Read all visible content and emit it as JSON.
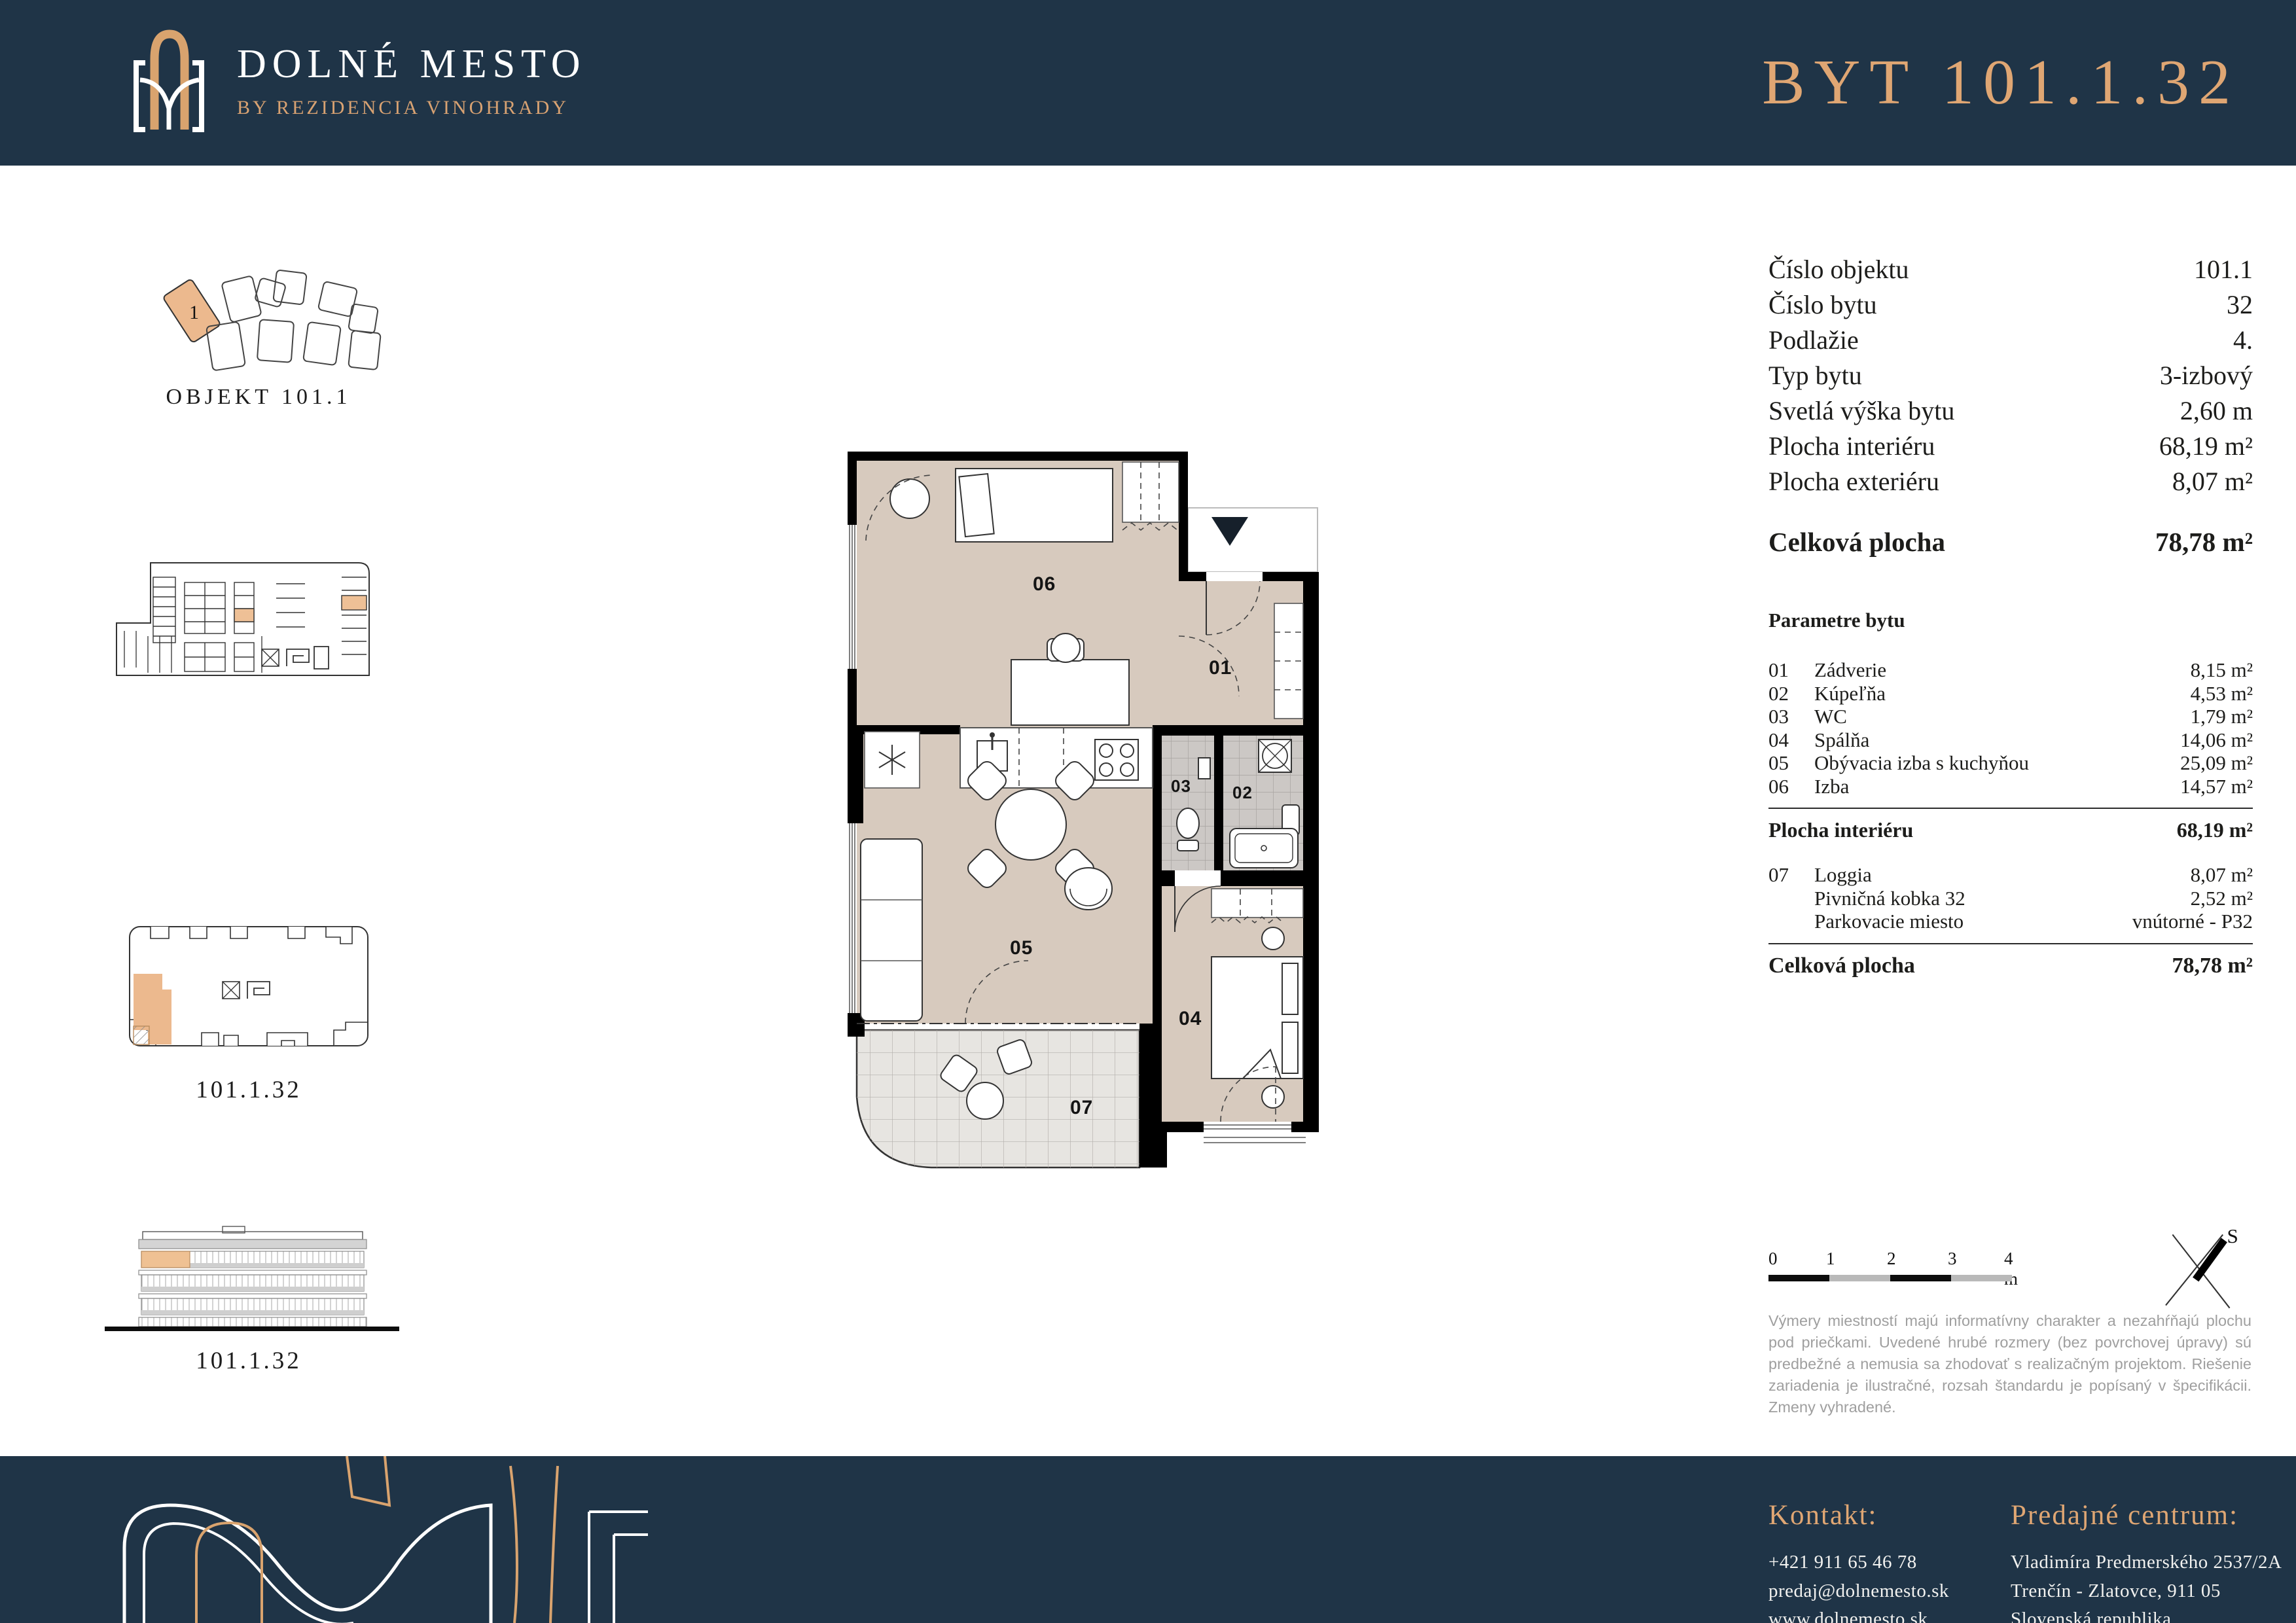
{
  "colors": {
    "navy": "#1f3447",
    "gold": "#dfa673",
    "beige": "#d7cabe",
    "tile": "#ccc8c5",
    "loggia": "#e7e5e1",
    "highlight": "#edbd92",
    "disclaimer_gray": "#9f9f9f"
  },
  "header": {
    "logo_title": "DOLNÉ MESTO",
    "logo_subtitle": "BY REZIDENCIA VINOHRADY",
    "apartment_title": "BYT 101.1.32"
  },
  "sidebar": {
    "site_plan": {
      "caption": "OBJEKT 101.1",
      "highlight_label": "1"
    },
    "floor_key": {
      "caption": "101.1.32"
    },
    "elevation": {
      "caption": "101.1.32"
    }
  },
  "plan": {
    "labels": {
      "r01": "01",
      "r02": "02",
      "r03": "03",
      "r04": "04",
      "r05": "05",
      "r06": "06",
      "r07": "07"
    }
  },
  "details": {
    "rows": [
      {
        "label": "Číslo objektu",
        "value": "101.1"
      },
      {
        "label": "Číslo bytu",
        "value": "32"
      },
      {
        "label": "Podlažie",
        "value": "4."
      },
      {
        "label": "Typ bytu",
        "value": "3-izbový"
      },
      {
        "label": "Svetlá výška bytu",
        "value": "2,60 m"
      },
      {
        "label": "Plocha interiéru",
        "value": "68,19 m²"
      },
      {
        "label": "Plocha exteriéru",
        "value": "8,07 m²"
      }
    ],
    "total": {
      "label": "Celková plocha",
      "value": "78,78 m²"
    }
  },
  "parameters": {
    "title": "Parametre bytu",
    "rows": [
      {
        "num": "01",
        "label": "Zádverie",
        "value": "8,15 m²"
      },
      {
        "num": "02",
        "label": "Kúpeľňa",
        "value": "4,53 m²"
      },
      {
        "num": "03",
        "label": "WC",
        "value": "1,79 m²"
      },
      {
        "num": "04",
        "label": "Spálňa",
        "value": "14,06 m²"
      },
      {
        "num": "05",
        "label": "Obývacia izba s kuchyňou",
        "value": "25,09 m²"
      },
      {
        "num": "06",
        "label": "Izba",
        "value": "14,57 m²"
      }
    ],
    "interior": {
      "label": "Plocha interiéru",
      "value": "68,19 m²"
    },
    "extras": [
      {
        "num": "07",
        "label": "Loggia",
        "value": "8,07 m²"
      },
      {
        "num": "",
        "label": "Pivničná kobka 32",
        "value": "2,52 m²"
      },
      {
        "num": "",
        "label": "Parkovacie miesto",
        "value": "vnútorné - P32"
      }
    ],
    "total": {
      "label": "Celková plocha",
      "value": "78,78 m²"
    }
  },
  "scale_bar": {
    "labels": [
      "0",
      "1",
      "2",
      "3",
      "4 m"
    ]
  },
  "compass": {
    "label": "S"
  },
  "disclaimer": "Výmery miestností majú informatívny charakter a nezahŕňajú plochu pod priečkami. Uvedené hrubé rozmery (bez povrchovej úpravy) sú predbežné a nemusia sa zhodovať s realizačným projektom. Riešenie zariadenia je ilustračné, rozsah štandardu je popísaný v špecifikácii. Zmeny vyhradené.",
  "footer": {
    "contact": {
      "title": "Kontakt:",
      "lines": [
        "+421 911 65 46 78",
        "predaj@dolnemesto.sk",
        "www.dolnemesto.sk"
      ]
    },
    "sales": {
      "title": "Predajné centrum:",
      "lines": [
        "Vladimíra Predmerského 2537/2A",
        "Trenčín - Zlatovce, 911 05",
        "Slovenská republika"
      ]
    }
  }
}
